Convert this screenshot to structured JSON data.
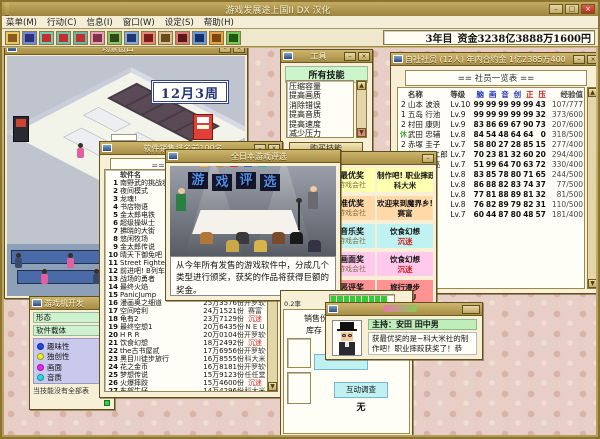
{
  "app": {
    "title": "游戏发展途上国II DX 汉化",
    "window_buttons": [
      "–",
      "□",
      "×"
    ],
    "menus": [
      {
        "label": "菜单(M)"
      },
      {
        "label": "行动(C)"
      },
      {
        "label": "信息(I)"
      },
      {
        "label": "窗口(W)"
      },
      {
        "label": "设定(S)"
      },
      {
        "label": "帮助(H)"
      }
    ],
    "toolbar_icons": [
      {
        "name": "save-icon",
        "bg": "#e8c860",
        "fg": "#8a5a20"
      },
      {
        "name": "security-icon",
        "bg": "#7088d8",
        "fg": "#30307a"
      },
      {
        "name": "stat-up-icon-1",
        "bg": "#78c8b0",
        "fg": "#c03030"
      },
      {
        "name": "stat-up-icon-2",
        "bg": "#70c0a8",
        "fg": "#c03030"
      },
      {
        "name": "stat-up-icon-3",
        "bg": "#68b8a0",
        "fg": "#c03030"
      },
      {
        "name": "shop-icon",
        "bg": "#e8a0b8",
        "fg": "#803048"
      },
      {
        "name": "team-icon",
        "bg": "#88c868",
        "fg": "#304818"
      },
      {
        "name": "building-icon",
        "bg": "#88a8e0",
        "fg": "#203870"
      },
      {
        "name": "award-icon",
        "bg": "#e88878",
        "fg": "#7a2018"
      },
      {
        "name": "mail-icon",
        "bg": "#d8c090",
        "fg": "#6a4a20"
      },
      {
        "name": "hr-icon",
        "bg": "#e07878",
        "fg": "#581818"
      },
      {
        "name": "monitor-icon",
        "bg": "#6898e0",
        "fg": "#183068"
      },
      {
        "name": "arcade-icon",
        "bg": "#e8a048",
        "fg": "#7a4810"
      },
      {
        "name": "plant-icon",
        "bg": "#78c858",
        "fg": "#205818"
      }
    ],
    "status": {
      "year": "3年目",
      "money": "资金3238亿3888万1600円"
    }
  },
  "scene_window": {
    "title": "场景窗口",
    "date": "12月3周"
  },
  "skills_window": {
    "title": "工具",
    "header": "所有技能",
    "items": [
      "压缩容量",
      "提高画质",
      "消除错误",
      "提高音质",
      "提高速度",
      "减少压力"
    ],
    "buy_button": "购买技能"
  },
  "employee_window": {
    "title": "自社社员 (12人) 年内合约金 1亿2385万400",
    "header": "== 社员一览表 ==",
    "columns": {
      "name": "名称",
      "level": "等级",
      "exp": "经验值",
      "stats": [
        {
          "label": "脑",
          "color": "#2233bb"
        },
        {
          "label": "画",
          "color": "#2233bb"
        },
        {
          "label": "音",
          "color": "#2233bb"
        },
        {
          "label": "创",
          "color": "#2233bb"
        },
        {
          "label": "正",
          "color": "#bb2222"
        },
        {
          "label": "压",
          "color": "#bb2222"
        }
      ]
    },
    "rows": [
      {
        "tag": "2",
        "name": "山本 波浪",
        "level": "Lv.10",
        "stats": [
          99,
          99,
          99,
          99,
          99,
          43
        ],
        "exp": "107/777"
      },
      {
        "tag": "1",
        "name": "五岛 行池",
        "level": "Lv.9",
        "stats": [
          99,
          99,
          99,
          99,
          99,
          32
        ],
        "exp": "373/600"
      },
      {
        "tag": "2",
        "name": "村田 康则",
        "level": "Lv.9",
        "stats": [
          83,
          86,
          69,
          67,
          90,
          73
        ],
        "exp": "207/600"
      },
      {
        "tag": "休",
        "name": "武田 忠辅",
        "level": "Lv.8",
        "stats": [
          84,
          54,
          48,
          64,
          64,
          0
        ],
        "exp": "318/500"
      },
      {
        "tag": "2",
        "name": "赤塚 圭子",
        "level": "Lv.7",
        "stats": [
          58,
          80,
          27,
          28,
          85,
          15
        ],
        "exp": "277/400"
      },
      {
        "tag": "1",
        "name": "桥本 龙二郎",
        "level": "Lv.7",
        "stats": [
          70,
          23,
          81,
          32,
          60,
          20
        ],
        "exp": "294/400"
      },
      {
        "tag": "1",
        "name": "喜兄 佳亮",
        "level": "Lv.7",
        "stats": [
          51,
          99,
          64,
          70,
          63,
          72
        ],
        "exp": "330/400"
      },
      {
        "tag": "",
        "name": "",
        "level": "Lv.8",
        "stats": [
          83,
          85,
          78,
          80,
          71,
          65
        ],
        "exp": "244/500"
      },
      {
        "tag": "",
        "name": "",
        "level": "Lv.8",
        "stats": [
          86,
          88,
          82,
          83,
          74,
          37
        ],
        "exp": "77/500"
      },
      {
        "tag": "",
        "name": "",
        "level": "Lv.8",
        "stats": [
          77,
          81,
          88,
          89,
          81,
          32
        ],
        "exp": "81/500"
      },
      {
        "tag": "",
        "name": "",
        "level": "Lv.8",
        "stats": [
          76,
          82,
          89,
          79,
          82,
          31
        ],
        "exp": "110/500"
      },
      {
        "tag": "",
        "name": "",
        "level": "Lv.7",
        "stats": [
          60,
          44,
          87,
          80,
          48,
          57
        ],
        "exp": "181/400"
      }
    ]
  },
  "ranking_window": {
    "title": "软件销售排名前100名",
    "header": "== 排名前100名 ==",
    "column": "软件名",
    "rows": [
      {
        "rank": 1,
        "name": "南野武的挑战状",
        "sales": "",
        "company": "",
        "red": false
      },
      {
        "rank": 2,
        "name": "夜间模式",
        "sales": "",
        "company": "",
        "red": false
      },
      {
        "rank": 3,
        "name": "龙魂!",
        "sales": "",
        "company": "",
        "red": false
      },
      {
        "rank": 4,
        "name": "书店物语",
        "sales": "",
        "company": "",
        "red": false
      },
      {
        "rank": 5,
        "name": "金太郎电铁",
        "sales": "",
        "company": "",
        "red": false
      },
      {
        "rank": 6,
        "name": "超级操纵士",
        "sales": "",
        "company": "",
        "red": false
      },
      {
        "rank": 7,
        "name": "拂晓的大街",
        "sales": "",
        "company": "",
        "red": false
      },
      {
        "rank": 8,
        "name": "悠闲牧场",
        "sales": "",
        "company": "",
        "red": false
      },
      {
        "rank": 9,
        "name": "金太郎传说",
        "sales": "",
        "company": "",
        "red": false
      },
      {
        "rank": 10,
        "name": "晴天下御免吧",
        "sales": "",
        "company": "",
        "red": false
      },
      {
        "rank": 11,
        "name": "Street Fighter",
        "sales": "",
        "company": "",
        "red": false
      },
      {
        "rank": 12,
        "name": "前进吧! B列车",
        "sales": "",
        "company": "",
        "red": false
      },
      {
        "rank": 13,
        "name": "战场的勇者",
        "sales": "",
        "company": "",
        "red": false
      },
      {
        "rank": 14,
        "name": "最终火焰",
        "sales": "",
        "company": "",
        "red": false
      },
      {
        "rank": 15,
        "name": "PanicJump",
        "sales": "",
        "company": "",
        "red": false
      },
      {
        "rank": 16,
        "name": "漫画奥之细道",
        "sales": "25万3576份",
        "company": "开罗软件",
        "red": false
      },
      {
        "rank": 17,
        "name": "空间哈利",
        "sales": "24万1521份",
        "company": "赛富",
        "red": false
      },
      {
        "rank": 18,
        "name": "龟有2",
        "sales": "23万7129份",
        "company": "沉迷",
        "red": true
      },
      {
        "rank": 19,
        "name": "最终空想1",
        "sales": "20万6435份",
        "company": "N E U",
        "red": false
      },
      {
        "rank": 20,
        "name": "H R R",
        "sales": "20万0104份",
        "company": "开罗软件",
        "red": false
      },
      {
        "rank": 21,
        "name": "饮食幻想",
        "sales": "18万2492份",
        "company": "沉迷",
        "red": true
      },
      {
        "rank": 22,
        "name": "the古书屋贰",
        "sales": "17万6956份",
        "company": "开罗软件",
        "red": false
      },
      {
        "rank": 23,
        "name": "黑目川徒步旅行",
        "sales": "16万8555份",
        "company": "科大米",
        "red": false
      },
      {
        "rank": 24,
        "name": "花之金币",
        "sales": "16万8181份",
        "company": "开罗软件",
        "red": false
      },
      {
        "rank": 25,
        "name": "梦想传说",
        "sales": "15万9123份",
        "company": "任任堂",
        "red": false
      },
      {
        "rank": 26,
        "name": "火爆摔跤",
        "sales": "15万4600份",
        "company": "沉迷",
        "red": true
      },
      {
        "rank": 27,
        "name": "东部牛仔",
        "sales": "14万4296份",
        "company": "科大米",
        "red": false
      }
    ]
  },
  "awards_window": {
    "title": "全日本游戏评选",
    "banner": "游戏评选",
    "message": "从今年所有发售的游戏软件中，分成几个类型进行颁奖，获奖的作品将获得巨额的奖金。"
  },
  "award_list_window": {
    "org_label": "游戏会社",
    "rows": [
      {
        "award": "最优奖",
        "game": "制作吧! 职业摔跤",
        "company": "科大米",
        "bg": "#ffffb0",
        "trophy": "gold-trophy-icon",
        "red": false
      },
      {
        "award": "准优奖",
        "game": "欢迎来到魔界乡!",
        "company": "赛富",
        "bg": "#ffd9a8",
        "trophy": "candle-trophy-icon",
        "red": false
      },
      {
        "award": "音乐奖",
        "game": "饮食幻想",
        "company": "沉迷",
        "bg": "#c0f2f2",
        "trophy": "silver-trophy-icon",
        "red": true
      },
      {
        "award": "画面奖",
        "game": "饮食幻想",
        "company": "沉迷",
        "bg": "#ffc9ee",
        "trophy": "silver-trophy-icon",
        "red": true
      },
      {
        "award": "恶评奖",
        "game": "旅行漫步",
        "company": "N E U",
        "bg": "#ff9393",
        "trophy": "dark-trophy-icon",
        "red": false
      }
    ]
  },
  "dev_window": {
    "title": "游戏机开发",
    "rows": [
      {
        "label": "形态",
        "value": "家"
      },
      {
        "label": "软件载体",
        "value": ""
      }
    ],
    "stats": [
      {
        "label": "趣味性",
        "color": "#2244ee"
      },
      {
        "label": "独创性",
        "color": "#eeee22"
      },
      {
        "label": "画面",
        "color": "#ee22ee"
      },
      {
        "label": "音质",
        "color": "#22dddd"
      }
    ],
    "note": "当技能没有全部表"
  },
  "sales_window": {
    "gauge_label": "0.2率",
    "labels": [
      "销售份数",
      "库存"
    ],
    "survey_button": "互动调查",
    "survey_value": "无"
  },
  "dialog_window": {
    "host": "主持：安田 田中男",
    "text": "获最优奖的是~科大米社的制作吧！职业摔跤获奖了！恭喜。"
  }
}
